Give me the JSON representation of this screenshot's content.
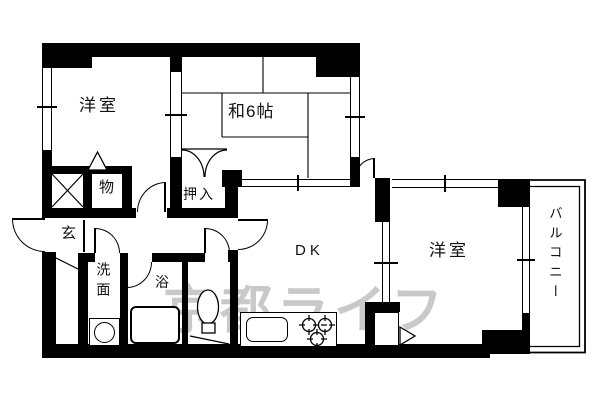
{
  "floorplan": {
    "watermark": "京都ライフ",
    "rooms": {
      "western_left": "洋室",
      "japanese": "和6帖",
      "storage": "物",
      "entrance": "玄",
      "closet": "押入",
      "washroom": "洗面",
      "bath": "浴",
      "dk": "DK",
      "western_right": "洋室",
      "balcony": "バルコニー"
    },
    "fixtures": {
      "toilet": "toilet-icon",
      "bathtub": "bathtub-icon",
      "washing_machine": "washing-machine-icon",
      "kitchen_sink": "kitchen-sink-icon",
      "stove": "stove-burners-icon",
      "pipe_shaft": "pipe-shaft-x-icon"
    },
    "colors": {
      "wall": "#000000",
      "watermark": "#c9c9c9",
      "background": "#ffffff",
      "line": "#000000"
    }
  }
}
